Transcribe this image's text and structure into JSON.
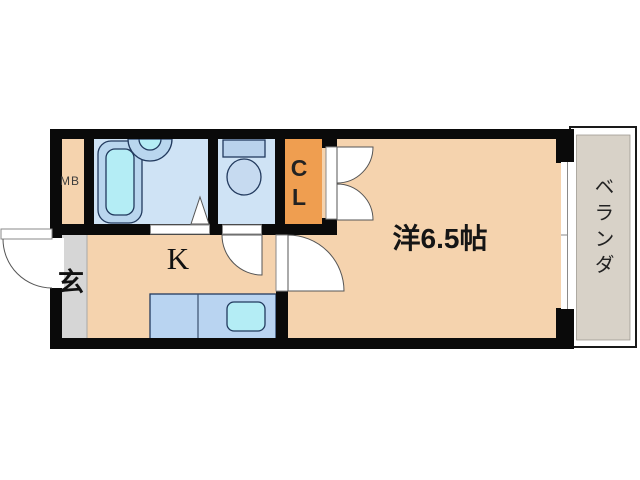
{
  "labels": {
    "meter_box": "MB",
    "closet_chars": [
      "C",
      "L"
    ],
    "kitchen": "K",
    "entrance": "玄",
    "main_room": "洋6.5帖",
    "balcony": "ベランダ"
  },
  "palette": {
    "wall": "#0a0a0a",
    "room_tan": "#f5d3ae",
    "entrance_gray": "#d6d6d6",
    "balcony_floor": "#d8d2c8",
    "wet_area_blue": "#cfe3f5",
    "closet_orange": "#ef9e50",
    "fixture_blue": "#b9d6ee",
    "fixture_cyan": "#b4edf5",
    "toilet_tank_blue": "#b9d2ec",
    "toilet_bowl_blue": "#c6daf0",
    "counter_blue": "#b9d4f1"
  }
}
